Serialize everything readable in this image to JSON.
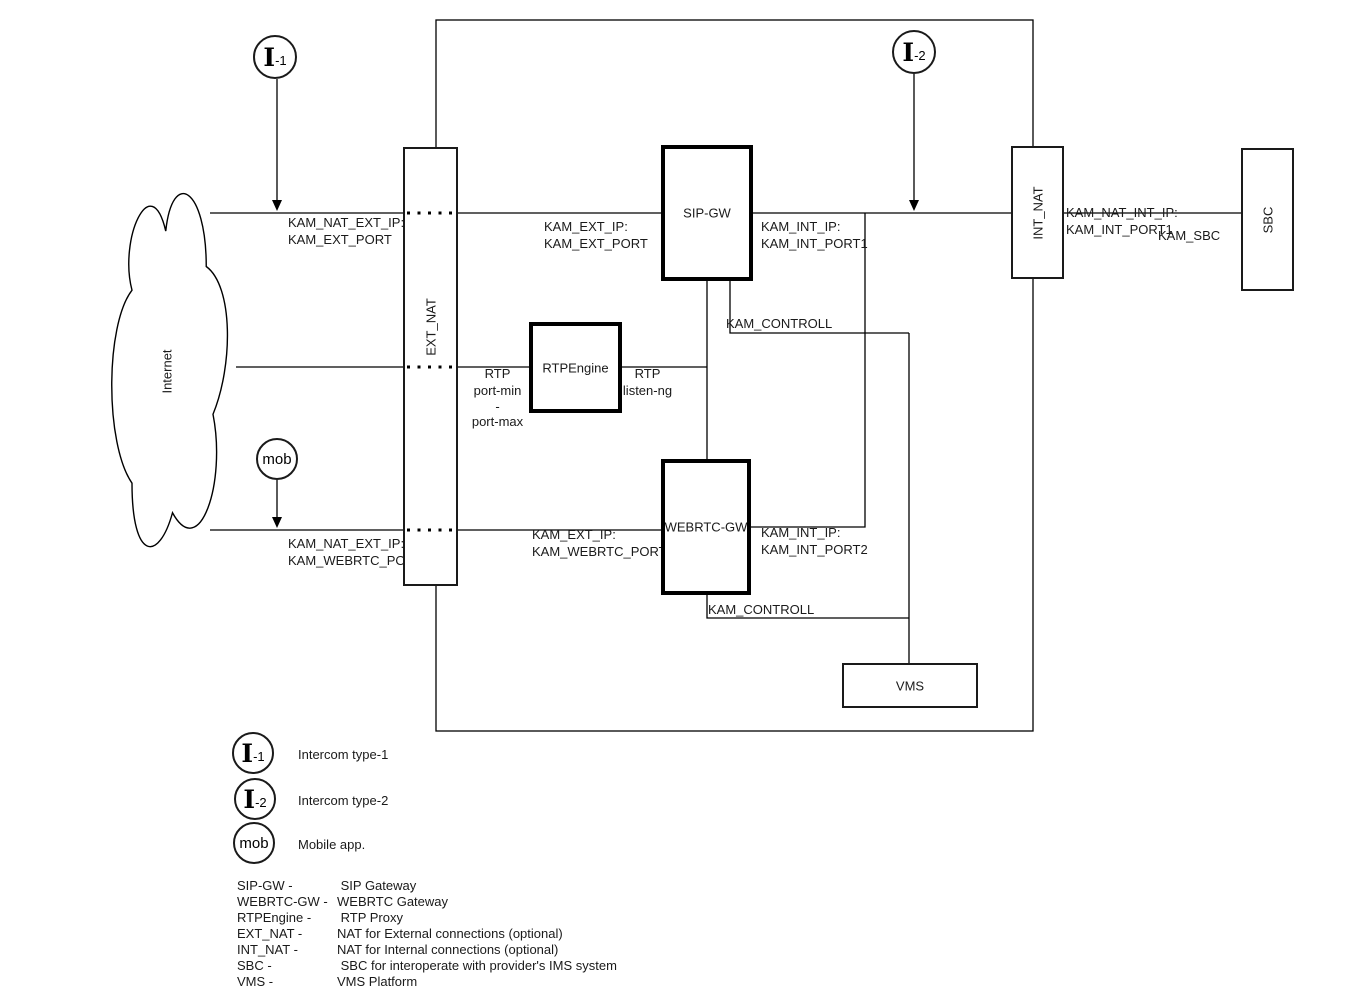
{
  "nodes": {
    "internet": "Internet",
    "ext_nat": "EXT_NAT",
    "sip_gw": "SIP-GW",
    "rtpengine": "RTPEngine",
    "webrtc_gw": "WEBRTC-GW",
    "int_nat": "INT_NAT",
    "sbc": "SBC",
    "vms": "VMS"
  },
  "actors": {
    "i1": {
      "symbol": "I",
      "sub": "-1"
    },
    "i2": {
      "symbol": "I",
      "sub": "-2"
    },
    "mob": {
      "label": "mob"
    }
  },
  "labels": {
    "nat_ext_top": {
      "line1": "KAM_NAT_EXT_IP:",
      "line2": "KAM_EXT_PORT"
    },
    "ext_top": {
      "line1": "KAM_EXT_IP:",
      "line2": "KAM_EXT_PORT"
    },
    "int_top": {
      "line1": "KAM_INT_IP:",
      "line2": "KAM_INT_PORT1"
    },
    "nat_int": {
      "line1": "KAM_NAT_INT_IP:",
      "line2": "KAM_INT_PORT1"
    },
    "kam_sbc": "KAM_SBC",
    "kam_controll_top": "KAM_CONTROLL",
    "kam_controll_bottom": "KAM_CONTROLL",
    "rtp_left": {
      "line1": "RTP",
      "line2": "port-min",
      "line3": "-",
      "line4": "port-max"
    },
    "rtp_right": {
      "line1": "RTP",
      "line2": "listen-ng"
    },
    "nat_ext_bottom": {
      "line1": "KAM_NAT_EXT_IP:",
      "line2": "KAM_WEBRTC_PORT"
    },
    "ext_bottom": {
      "line1": "KAM_EXT_IP:",
      "line2": "KAM_WEBRTC_PORT"
    },
    "int_bottom": {
      "line1": "KAM_INT_IP:",
      "line2": "KAM_INT_PORT2"
    }
  },
  "legend": {
    "items": [
      {
        "symbol": "I",
        "sub": "-1",
        "label": "Intercom type-1"
      },
      {
        "symbol": "I",
        "sub": "-2",
        "label": "Intercom type-2"
      },
      {
        "symbol": "mob",
        "sub": "",
        "label": "Mobile app."
      }
    ],
    "terms": [
      {
        "term": "SIP-GW -",
        "def": " SIP Gateway"
      },
      {
        "term": "WEBRTC-GW -",
        "def": "WEBRTC Gateway"
      },
      {
        "term": "RTPEngine -",
        "def": " RTP Proxy"
      },
      {
        "term": "EXT_NAT -",
        "def": "NAT for External connections (optional)"
      },
      {
        "term": "INT_NAT -",
        "def": "NAT for Internal connections (optional)"
      },
      {
        "term": "SBC -",
        "def": " SBC for interoperate with provider's IMS system"
      },
      {
        "term": "VMS -",
        "def": "VMS Platform"
      }
    ]
  },
  "colors": {
    "stroke": "#000000",
    "node_fill": "#ffffff",
    "background": "#ffffff"
  }
}
